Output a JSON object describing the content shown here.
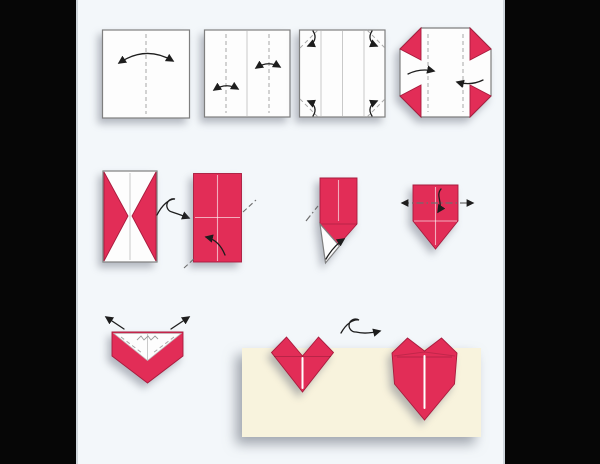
{
  "title": "Origami heart folding diagram",
  "colors": {
    "bg_black": "#060606",
    "canvas": "#f3f7fa",
    "paper_white": "#fdfdfd",
    "paper_red": "#e22d57",
    "paper_red_edge": "#a81b3d",
    "card_cream": "#f8f3dd",
    "outline_gray": "#7f7f7f",
    "panel_line": "#c9c9c9",
    "crease_gray": "#a8a8a8",
    "dash_dark": "#6e6e6e",
    "arrow_black": "#1d1d1d"
  },
  "steps": [
    {
      "id": "1",
      "label": "Square: crease vertical center line (fold and unfold)"
    },
    {
      "id": "2",
      "label": "Crease left and right quarter lines (fold edges to center)"
    },
    {
      "id": "3",
      "label": "Fold all four corners inward to the quarter lines"
    },
    {
      "id": "4",
      "label": "Octagon: fold both side panels in to the center"
    },
    {
      "id": "5",
      "label": "Folded panels with corner triangles; turn the model over"
    },
    {
      "id": "6",
      "label": "Red rectangle: fold lower corner up along the diagonal"
    },
    {
      "id": "7",
      "label": "Fold the bottom flaps to form the point"
    },
    {
      "id": "8",
      "label": "Fold the top edge behind along the dash-dot line"
    },
    {
      "id": "9",
      "label": "Pull the top corners outward"
    },
    {
      "id": "10",
      "label": "Heart back view; turn the model over"
    },
    {
      "id": "11",
      "label": "Finished origami heart"
    }
  ]
}
